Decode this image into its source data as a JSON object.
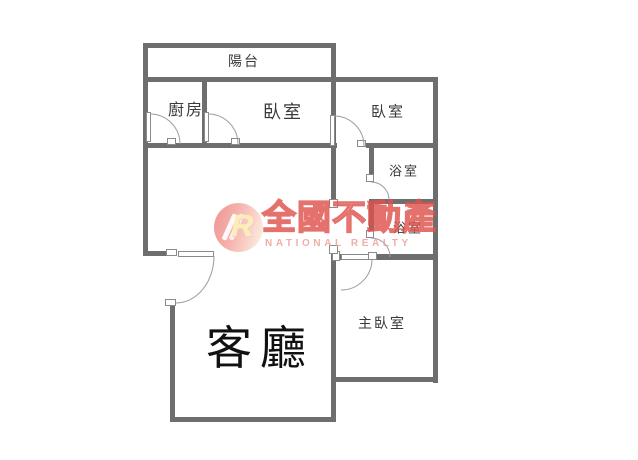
{
  "floorplan": {
    "rooms": {
      "balcony": "陽台",
      "kitchen": "廚房",
      "bedroom1": "臥室",
      "bedroom2": "臥室",
      "bathroom1": "浴室",
      "bathroom2": "浴室",
      "master_bedroom": "主臥室",
      "living_room": "客廳"
    }
  },
  "watermark": {
    "logo_letter": "R",
    "brand_name": "全國不動產",
    "brand_name_en": "NATIONAL REALTY",
    "colors": {
      "brand_stroke": "#e0524e",
      "brand_fill": "#f8c0b8",
      "circle_pink": "#ee8781",
      "en_text": "#ee9c96"
    }
  },
  "style": {
    "wall_color": "#6e6e6e",
    "door_line_color": "#9c9c9c",
    "label_color": "#3a3a3a"
  }
}
